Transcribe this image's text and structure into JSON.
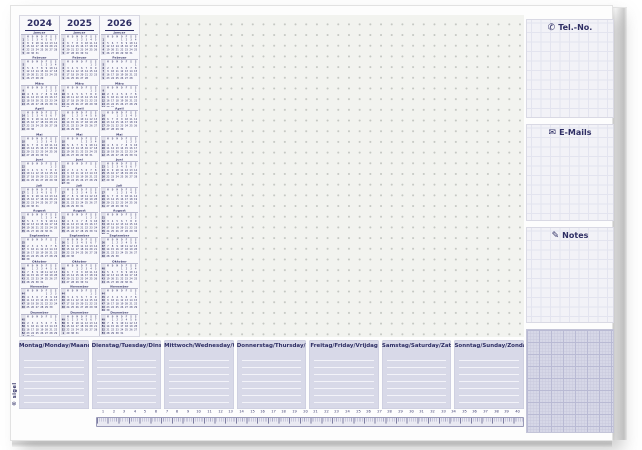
{
  "pad": {
    "brand": "© sigel",
    "years": [
      "2024",
      "2025",
      "2026"
    ],
    "month_names": [
      "Januar",
      "Februar",
      "März",
      "April",
      "Mai",
      "Juni",
      "Juli",
      "August",
      "September",
      "Oktober",
      "November",
      "Dezember"
    ],
    "weekday_initials": [
      "M",
      "D",
      "M",
      "D",
      "F",
      "S",
      "S"
    ],
    "side_panels": {
      "tel": {
        "label": "Tel.-No.",
        "icon_glyph": "✆"
      },
      "email": {
        "label": "E-Mails",
        "icon_glyph": "✉"
      },
      "notes": {
        "label": "Notes",
        "icon_glyph": "✎"
      }
    },
    "planner_days": [
      "Montag/Monday/Maandag",
      "Dienstag/Tuesday/Dinsdag",
      "Mittwoch/Wednesday/Woensdag",
      "Donnerstag/Thursday/Donderdag",
      "Freitag/Friday/Vrijdag",
      "Samstag/Saturday/Zaterdag",
      "Sonntag/Sunday/Zondag"
    ],
    "ruler_numbers": [
      1,
      2,
      3,
      4,
      5,
      6,
      7,
      8,
      9,
      10,
      11,
      12,
      13,
      14,
      15,
      16,
      17,
      18,
      19,
      20,
      21,
      22,
      23,
      24,
      25,
      26,
      27,
      28,
      29,
      30,
      31,
      32,
      33,
      34,
      35,
      36,
      37,
      38,
      39,
      40
    ],
    "colors": {
      "navy": "#2e2e64",
      "dot_paper": "#f2f3ef",
      "dot": "#c4c7c2",
      "panel_paper": "#f2f2f7",
      "planner_lavender": "#d8d9e8",
      "graph_lavender": "#d6d7e7"
    }
  }
}
